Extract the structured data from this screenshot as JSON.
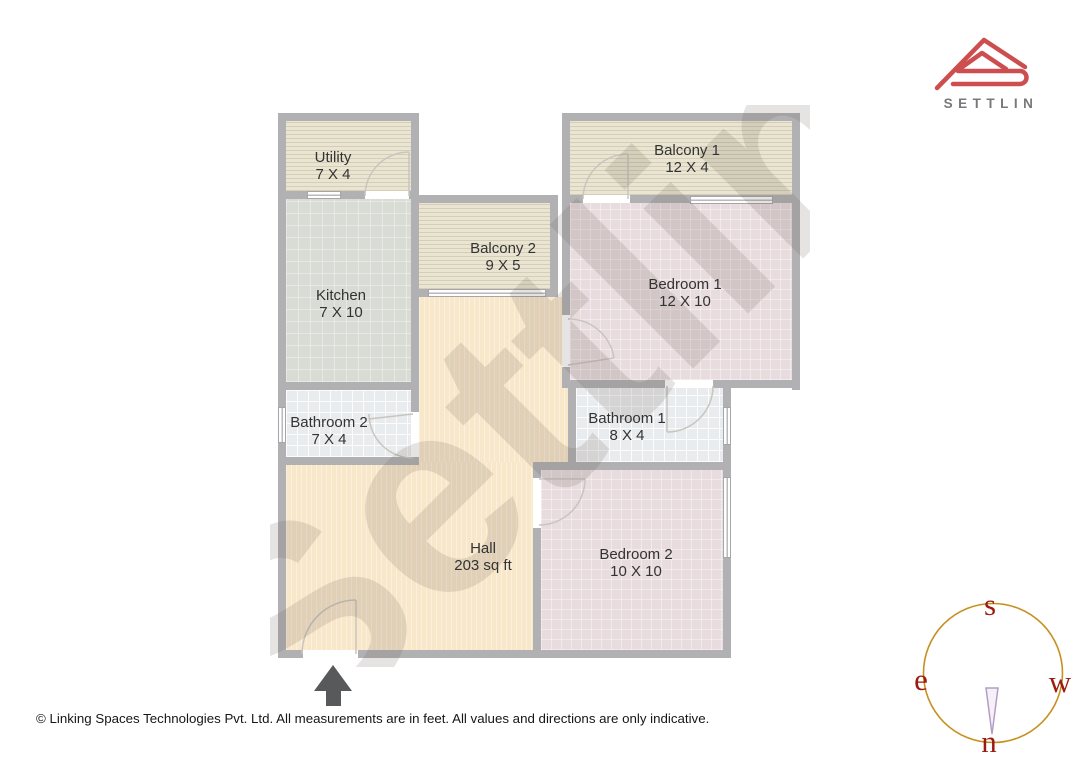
{
  "logo": {
    "brand": "SETTLIN",
    "icon": "settlin-roof-logo"
  },
  "watermark": "Settlin",
  "rooms": [
    {
      "id": "utility",
      "label": "Utility",
      "dims": "7 X 4"
    },
    {
      "id": "balcony1",
      "label": "Balcony 1",
      "dims": "12 X 4"
    },
    {
      "id": "balcony2",
      "label": "Balcony 2",
      "dims": "9 X 5"
    },
    {
      "id": "kitchen",
      "label": "Kitchen",
      "dims": "7 X 10"
    },
    {
      "id": "bedroom1",
      "label": "Bedroom 1",
      "dims": "12 X 10"
    },
    {
      "id": "bathroom2",
      "label": "Bathroom 2",
      "dims": "7 X 4"
    },
    {
      "id": "bathroom1",
      "label": "Bathroom 1",
      "dims": "8 X 4"
    },
    {
      "id": "hall",
      "label": "Hall",
      "dims": "203 sq ft"
    },
    {
      "id": "bedroom2",
      "label": "Bedroom 2",
      "dims": "10 X 10"
    }
  ],
  "compass": {
    "south": "s",
    "east": "e",
    "west": "w",
    "north": "n",
    "icon": "compass-rose"
  },
  "entrance": {
    "icon": "entrance-arrow"
  },
  "footer": {
    "copyright": "© Linking Spaces Technologies Pvt. Ltd. All measurements are in feet. All values and directions are only indicative."
  },
  "colors": {
    "wall": "#b1b1b3",
    "balcony": "#eae5d2",
    "kitchen": "#d9dbd5",
    "bath": "#e9ecee",
    "bed": "#e8dcdf",
    "hall": "#f9e7ca",
    "logo-red": "#cd4e4e",
    "brand-gray": "#77787b",
    "compass-ring": "#c79121",
    "compass-letter": "#9b1b10",
    "arrow": "#58595b",
    "door": "#c8c5bf",
    "wm": "rgba(97,89,77,0.16)"
  }
}
